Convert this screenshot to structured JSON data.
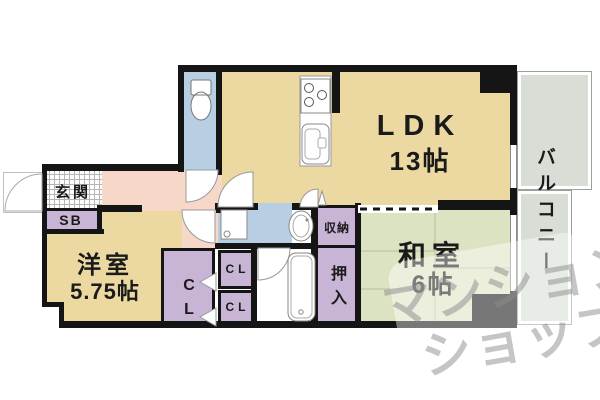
{
  "palette": {
    "wall": "#151515",
    "tan": "#ebd9a1",
    "green": "#dce3c3",
    "blue": "#b7cee3",
    "purple": "#c8b5d5",
    "pink": "#f7d7c7",
    "balcony": "#d8ded5",
    "wmcolor": "rgba(140,140,140,0.5)"
  },
  "rooms": {
    "ldk": {
      "name": "LDK",
      "size": "13帖"
    },
    "washitsu": {
      "name": "和室",
      "size": "6帖"
    },
    "yoshitsu": {
      "name": "洋室",
      "size": "5.75帖"
    },
    "balcony": {
      "name": "バルコニー"
    },
    "genkan": {
      "name": "玄関"
    }
  },
  "storage": {
    "sb": "SB",
    "shuunou": "収納",
    "oshiire": "押入",
    "cl_big_top": "C",
    "cl_big_bottom": "L",
    "cl_small_top": "CL",
    "cl_small_bottom": "CL"
  },
  "watermark": {
    "line1": "マンション",
    "line2": "ショップ"
  }
}
